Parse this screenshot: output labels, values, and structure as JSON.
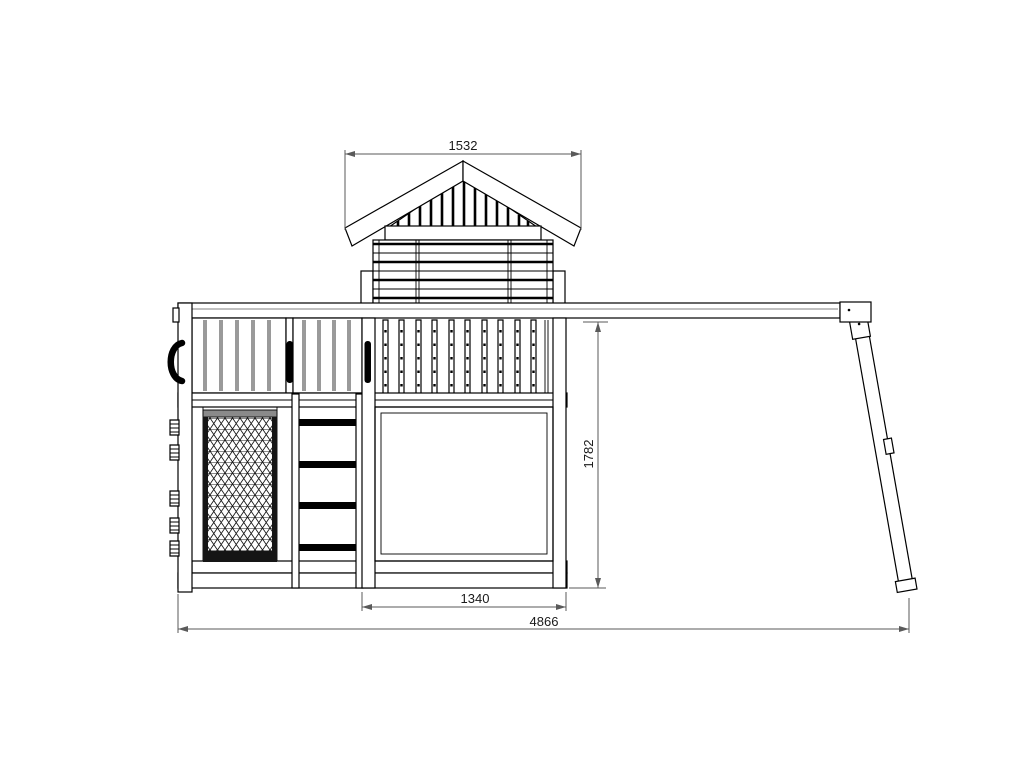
{
  "drawing": {
    "kind": "technical elevation drawing of playground structure",
    "dimension_labels": {
      "roof_width": "1532",
      "deck_height": "1782",
      "lower_bay_width": "1340",
      "overall_width": "4866"
    },
    "colors": {
      "background": "#ffffff",
      "structure_line": "#000000",
      "plank_gap": "#9a9a9a",
      "dimension_line": "#5a5a5a",
      "dimension_text": "#1a1a1a",
      "hardware": "#000000"
    }
  }
}
